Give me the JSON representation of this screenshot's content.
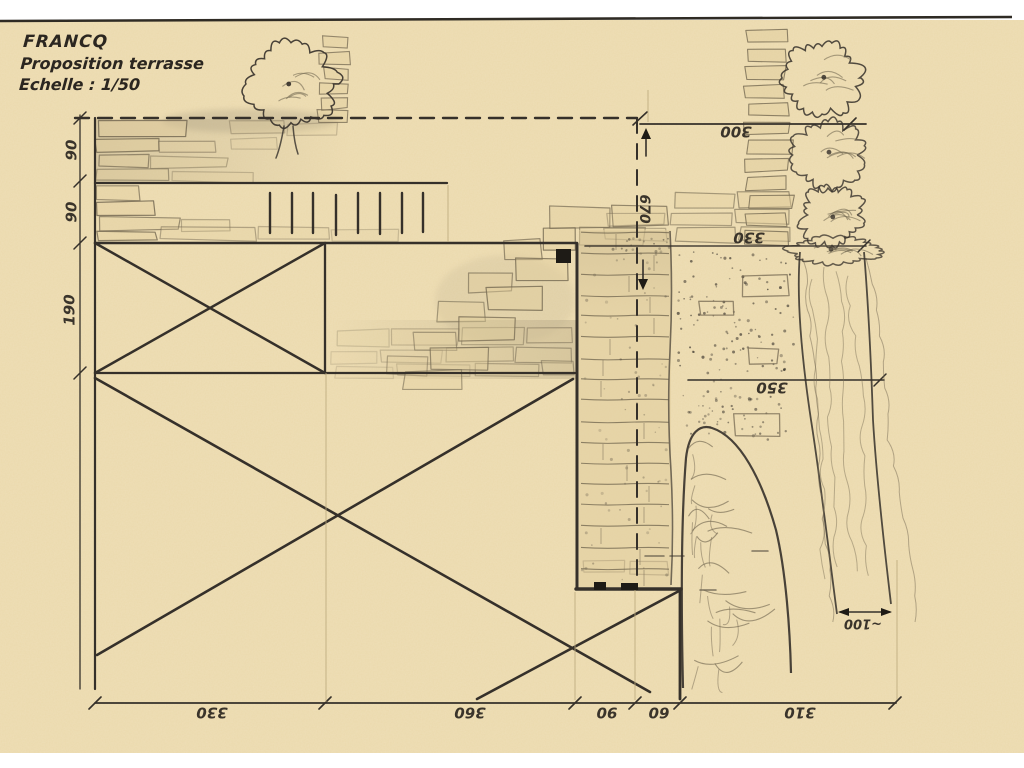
{
  "title_block": {
    "client": "FRANCQ",
    "subtitle": "Proposition terrasse",
    "scale_label": "Echelle : 1/50"
  },
  "dimensions": {
    "left_vertical": [
      "90",
      "90",
      "190"
    ],
    "bottom_horizontal": [
      "330",
      "360",
      "90",
      "60",
      "310"
    ],
    "right_top": "300",
    "right_upper": "330",
    "right_lower": "350",
    "offset_vertical": "670",
    "hedge_bottom": "~100"
  },
  "drawing": {
    "paper_color": "#ebd9ac",
    "ink_color": "#35302a",
    "pencil_color": "#b9a87b",
    "stone_fill": "#e0cc9b"
  }
}
